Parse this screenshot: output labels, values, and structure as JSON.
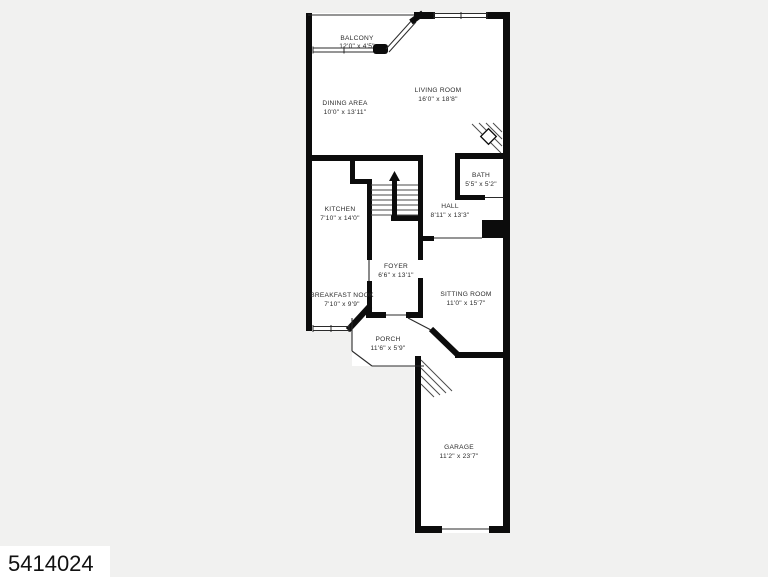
{
  "page": {
    "background_color": "#f1f1f0",
    "floor_color": "#ffffff",
    "wall_color": "#0c0c0c"
  },
  "watermark": {
    "text": "5414024"
  },
  "floorplan": {
    "type": "residential-floor-plan",
    "rooms": [
      {
        "name": "BALCONY",
        "dims": "12'0\" x 4'5\""
      },
      {
        "name": "LIVING ROOM",
        "dims": "16'0\" x 18'8\""
      },
      {
        "name": "DINING AREA",
        "dims": "10'0\" x 13'11\""
      },
      {
        "name": "KITCHEN",
        "dims": "7'10\" x 14'0\""
      },
      {
        "name": "BATH",
        "dims": "5'5\" x 5'2\""
      },
      {
        "name": "HALL",
        "dims": "8'11\" x 13'3\""
      },
      {
        "name": "FOYER",
        "dims": "6'6\" x 13'1\""
      },
      {
        "name": "BREAKFAST NOOK",
        "dims": "7'10\" x 9'9\""
      },
      {
        "name": "SITTING ROOM",
        "dims": "11'0\" x 15'7\""
      },
      {
        "name": "PORCH",
        "dims": "11'6\" x 5'9\""
      },
      {
        "name": "GARAGE",
        "dims": "11'2\" x 23'7\""
      }
    ]
  }
}
